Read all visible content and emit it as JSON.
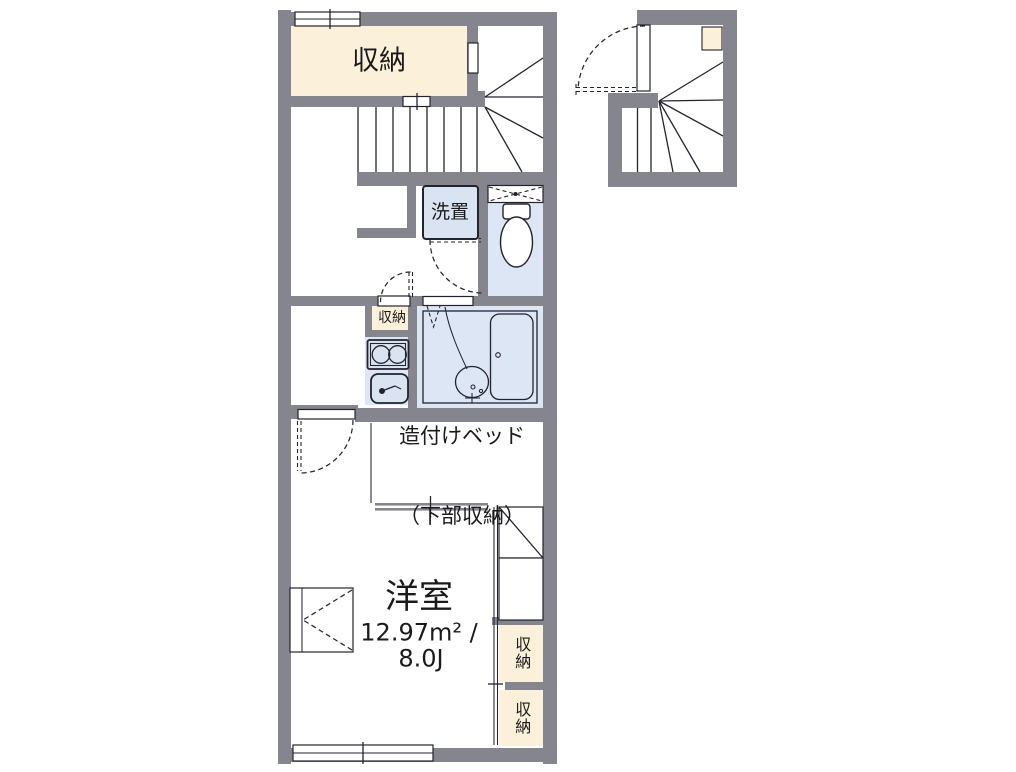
{
  "plan_title": "apartment-floor-plan",
  "rooms": {
    "storage_top": {
      "name": "収納"
    },
    "washer": {
      "name": "洗置"
    },
    "storage_hall": {
      "name": "収納"
    },
    "built_in_bed": {
      "line1": "造付けベッド",
      "line2": "（下部収納）"
    },
    "western_room": {
      "name": "洋室",
      "area_sqm": "12.97m² /",
      "area_jo": "8.0J"
    },
    "storage_right_upper": {
      "name": "収納"
    },
    "storage_right_lower": {
      "name": "収納"
    }
  },
  "fixtures": [
    "toilet-icon",
    "bathtub-icon",
    "washbasin-icon",
    "stove-icon",
    "kitchen-sink-icon",
    "staircase-icon",
    "door-swing-icon",
    "folding-door-icon",
    "window-icon",
    "vent-window-icon"
  ],
  "colors": {
    "wall": "#85858d",
    "storage": "#fbf1da",
    "wetroom": "#dce6f4",
    "fixture": "#d9e3f2",
    "line": "#23232e",
    "text": "#1a1a1a",
    "bg": "#ffffff"
  }
}
